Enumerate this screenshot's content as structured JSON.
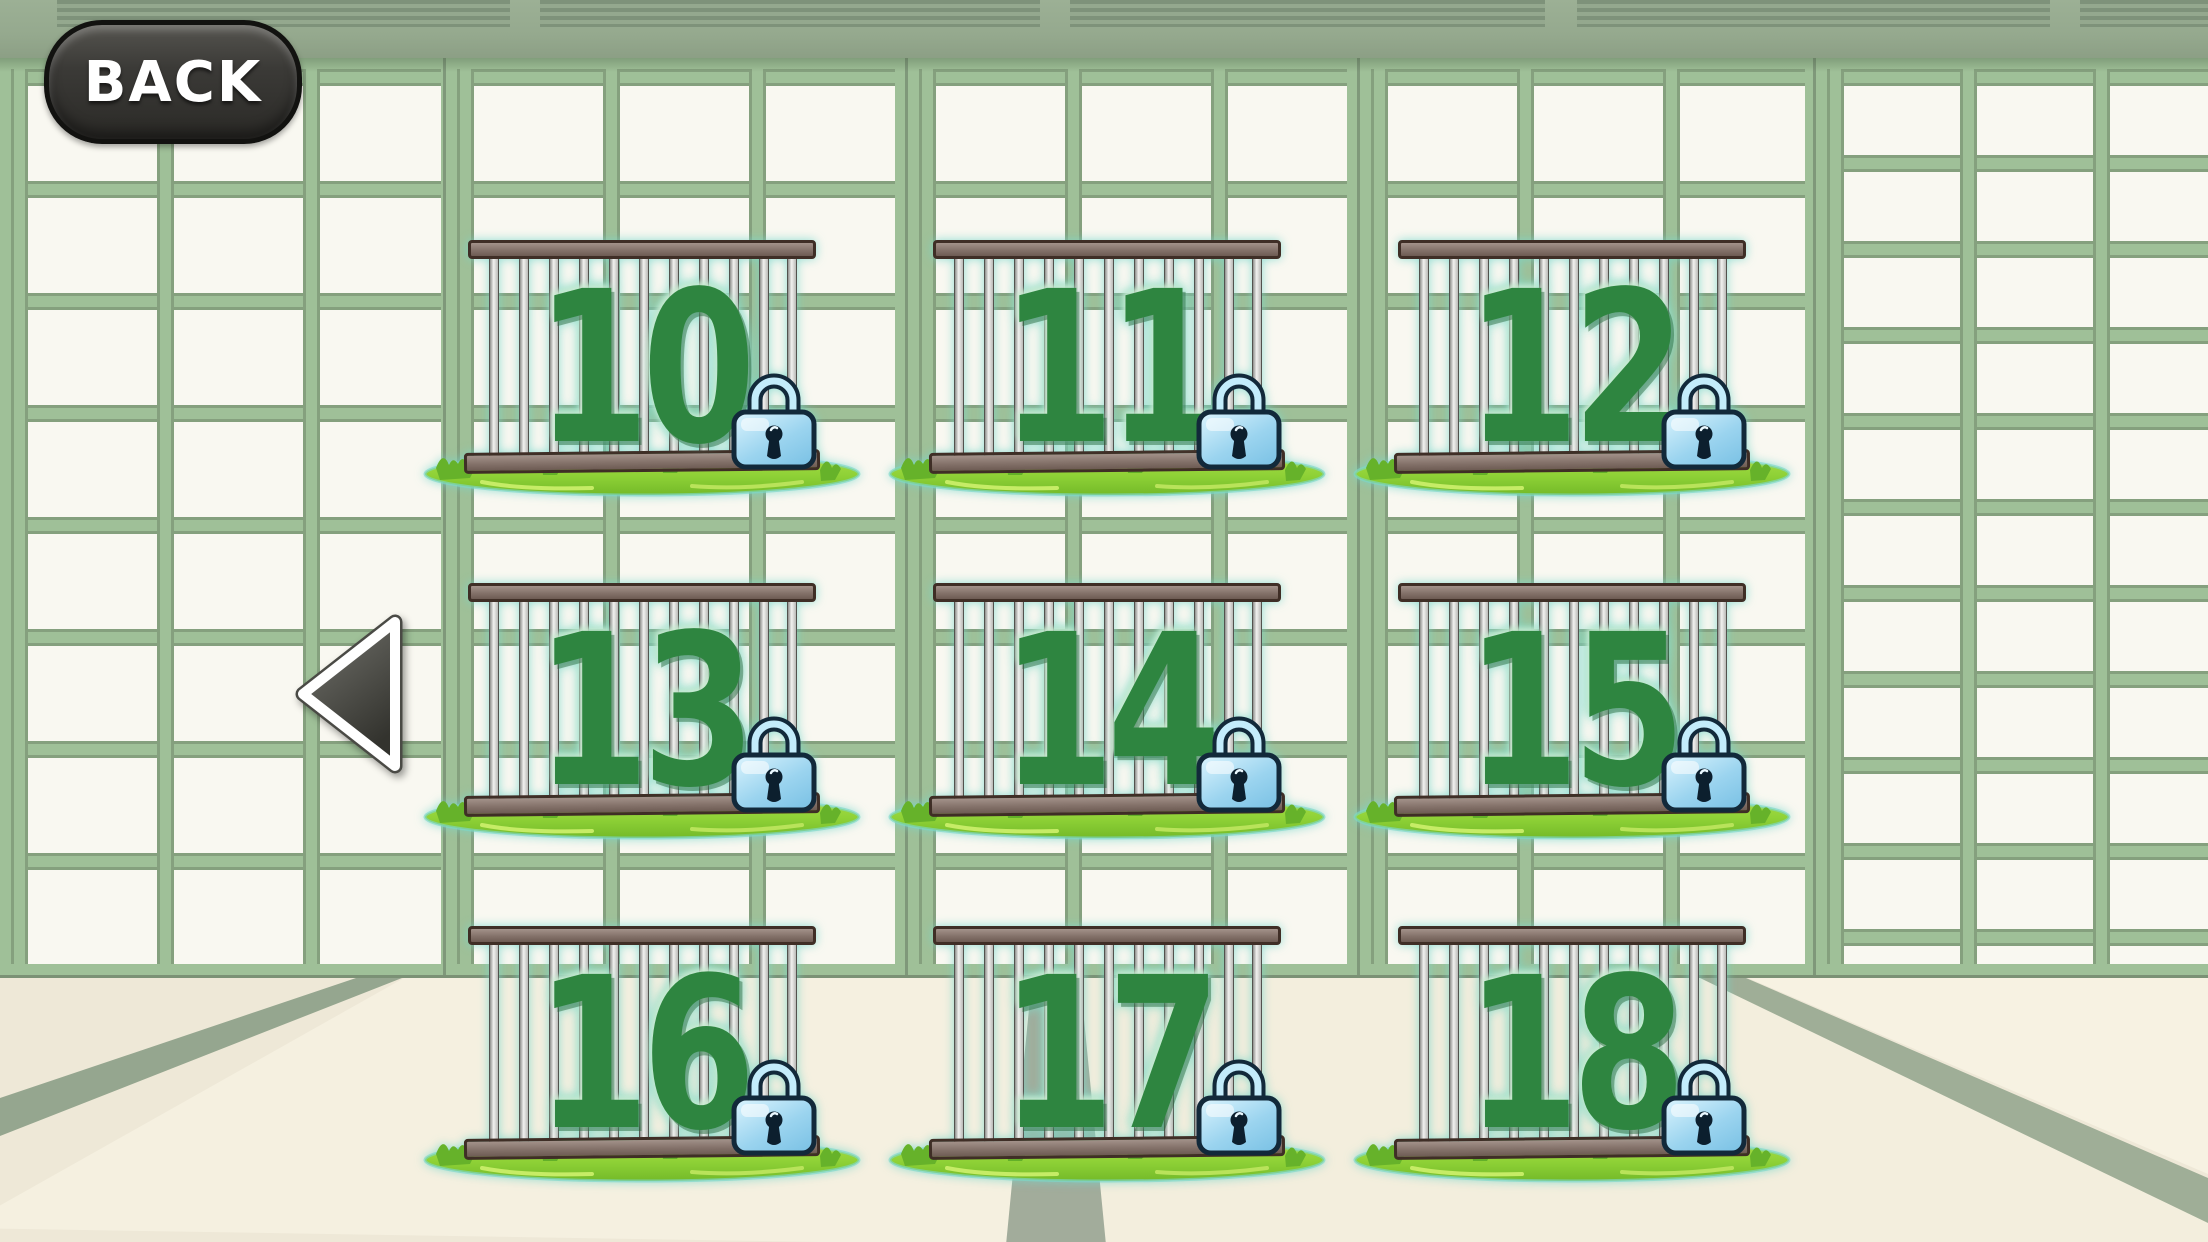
{
  "screen": {
    "name": "level-select"
  },
  "back_button": {
    "label": "BACK"
  },
  "pagination": {
    "prev": "previous-levels"
  },
  "levels": [
    {
      "number": "10",
      "locked": true
    },
    {
      "number": "11",
      "locked": true
    },
    {
      "number": "12",
      "locked": true
    },
    {
      "number": "13",
      "locked": true
    },
    {
      "number": "14",
      "locked": true
    },
    {
      "number": "15",
      "locked": true
    },
    {
      "number": "16",
      "locked": true
    },
    {
      "number": "17",
      "locked": true
    },
    {
      "number": "18",
      "locked": true
    }
  ],
  "icons": {
    "lock": "padlock-icon",
    "prev_arrow": "triangle-left-icon"
  },
  "colors": {
    "wall_frame": "#9fc098",
    "wall_panel": "#f9f8f1",
    "wall_gap": "#87a081",
    "beam": "#95a98e",
    "floor": "#eee8d7",
    "floor_stripe": "#95a68f",
    "cage_wood": "#84726a",
    "number_green": "#2e8540",
    "lock_blue": "#9bd4ef",
    "grass_green": "#8ed136",
    "button_dark": "#3b3a37"
  }
}
